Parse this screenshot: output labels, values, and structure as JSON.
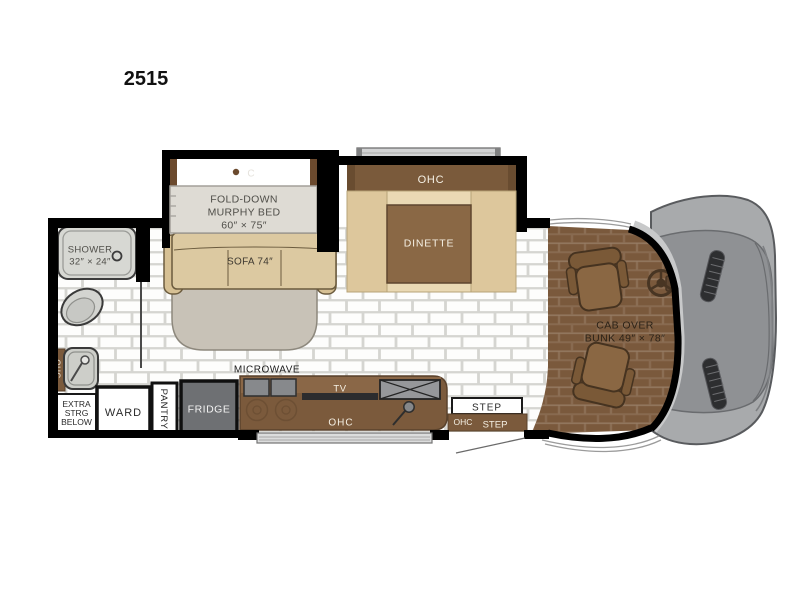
{
  "page": {
    "title": "2515"
  },
  "colors": {
    "wall": "#000000",
    "cabinet_brown": "#7b5a3c",
    "dark_brown_edge": "#5a422c",
    "tan_sofa": "#dcc9a1",
    "cream_dinette": "#ead9b4",
    "carpet_brown": "#7a593c",
    "hood_gray": "#8f9194",
    "floor_white": "#ffffff",
    "appliance_gray": "#6e7073"
  },
  "floorplan": {
    "bedroom": {
      "murphy_bed_line1": "FOLD-DOWN",
      "murphy_bed_line2": "MURPHY BED",
      "murphy_bed_line3": "60″ × 75″",
      "murphy_logo": "C",
      "sofa": "SOFA 74″"
    },
    "dinette": {
      "ohc": "OHC",
      "label": "DINETTE"
    },
    "bathroom": {
      "shower_line1": "SHOWER",
      "shower_line2": "32″ × 24″"
    },
    "storage": {
      "ohc_vertical": "OHC",
      "extra_line1": "EXTRA",
      "extra_line2": "STRG",
      "extra_line3": "BELOW",
      "ward": "WARD",
      "pantry": "PANTRY"
    },
    "kitchen": {
      "microwave": "MICROWAVE",
      "fridge": "FRIDGE",
      "tv": "TV",
      "ohc": "OHC"
    },
    "entry": {
      "step_top": "STEP",
      "ohc": "OHC",
      "step_bottom": "STEP"
    },
    "cab": {
      "bunk_line1": "CAB OVER",
      "bunk_line2": "BUNK 49″ × 78″"
    }
  }
}
